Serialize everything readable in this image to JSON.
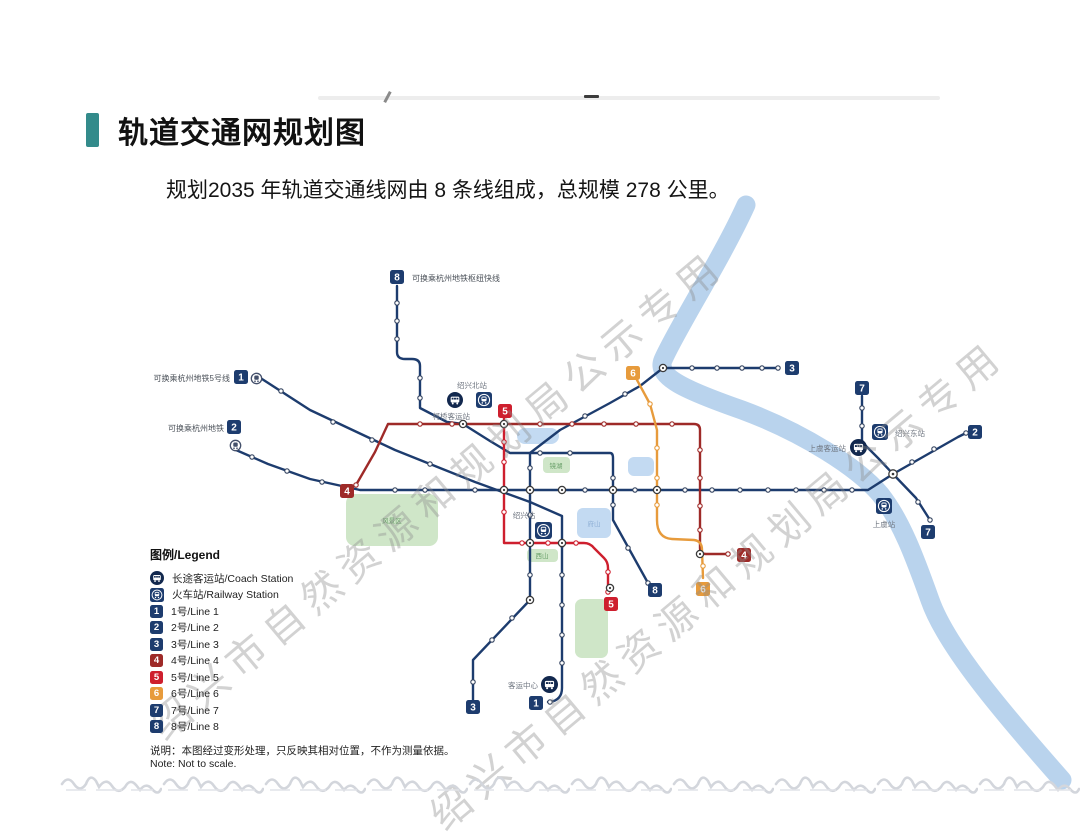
{
  "page": {
    "title": "轨道交通网规划图",
    "subtitle": "规划2035 年轨道交通线网由 8 条线组成，总规模 278 公里。"
  },
  "colors": {
    "accent_teal": "#338b8b",
    "line_navy": "#1d3c6e",
    "line4_maroon": "#9e2a28",
    "line5_red": "#ce1f2e",
    "line6_orange": "#e79b3c",
    "river_blue": "#b9d3ed",
    "park_green": "#cfe6c8",
    "lake_blue": "#c3daf2",
    "watermark_gray": "#8c8c8c"
  },
  "watermark": {
    "text": "绍兴市自然资源和规划局公示专用"
  },
  "legend": {
    "title": "图例/Legend",
    "stations": [
      {
        "icon": "coach-station-icon",
        "label": "长途客运站/Coach Station"
      },
      {
        "icon": "railway-station-icon",
        "label": "火车站/Railway Station"
      }
    ],
    "lines": [
      {
        "num": "1",
        "label": "1号/Line 1",
        "color": "#1d3c6e"
      },
      {
        "num": "2",
        "label": "2号/Line 2",
        "color": "#1d3c6e"
      },
      {
        "num": "3",
        "label": "3号/Line 3",
        "color": "#1d3c6e"
      },
      {
        "num": "4",
        "label": "4号/Line 4",
        "color": "#9e2a28"
      },
      {
        "num": "5",
        "label": "5号/Line 5",
        "color": "#ce1f2e"
      },
      {
        "num": "6",
        "label": "6号/Line 6",
        "color": "#e79b3c"
      },
      {
        "num": "7",
        "label": "7号/Line 7",
        "color": "#1d3c6e"
      },
      {
        "num": "8",
        "label": "8号/Line 8",
        "color": "#1d3c6e"
      }
    ],
    "note_cn": "说明：本图经过变形处理，只反映其相对位置，不作为测量依据。",
    "note_en": "Note: Not to scale."
  },
  "map": {
    "transfer_labels": {
      "line8_hub": "可换乘杭州地铁枢纽快线",
      "hz_line5": "可换乘杭州地铁5号线",
      "hz_metro": "可换乘杭州地铁"
    },
    "stations": {
      "shaoxing_north": "绍兴北站",
      "keqiao_coach": "柯桥客运站",
      "shaoxing": "绍兴站",
      "shaoxing_east": "绍兴东站",
      "shangyu": "上虞站",
      "shangyu_coach": "上虞客运站",
      "coach_center": "客运中心",
      "jinghu_park": "镜湖",
      "fushan_park": "府山",
      "xishan_park": "西山",
      "scenic_area": "风景区"
    },
    "badges": [
      {
        "num": "8"
      },
      {
        "num": "1"
      },
      {
        "num": "2"
      },
      {
        "num": "3"
      },
      {
        "num": "7"
      },
      {
        "num": "2"
      },
      {
        "num": "7"
      },
      {
        "num": "6"
      },
      {
        "num": "5"
      },
      {
        "num": "4"
      },
      {
        "num": "4"
      },
      {
        "num": "6"
      },
      {
        "num": "8"
      },
      {
        "num": "5"
      },
      {
        "num": "3"
      },
      {
        "num": "1"
      }
    ]
  }
}
